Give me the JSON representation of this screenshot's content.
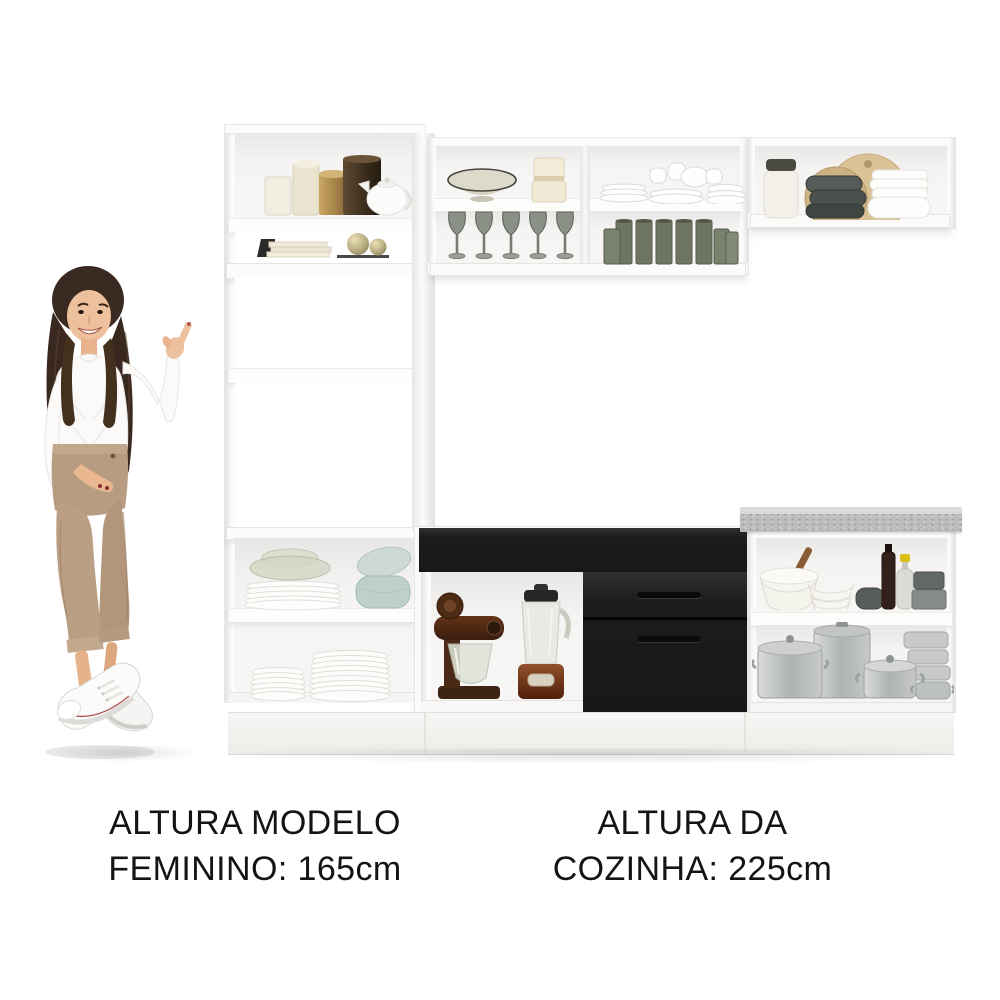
{
  "captions": {
    "model_height": {
      "line1": "ALTURA MODELO",
      "line2": "FEMININO: 165cm"
    },
    "kitchen_height": {
      "line1": "ALTURA DA",
      "line2": "COZINHA: 225cm"
    }
  },
  "measurements": {
    "model_height": "165cm",
    "kitchen_height": "225cm"
  },
  "colors": {
    "background": "#ffffff",
    "cabinet_white": "#f7f6f4",
    "cabinet_outline": "#e3e2e0",
    "drawer_black": "#1c1c1a",
    "countertop_gray": "#bcbebb",
    "text_black": "#141414",
    "hair_brown": "#3a2a21",
    "skin": "#eec19e",
    "pants_tan": "#b89c81",
    "sneaker_white": "#fbfbfa",
    "appliance_copper": "#7c3d20",
    "gold_tin": "#b3914f",
    "smoke_glass": "#6e7565",
    "blue_bowls": "#c3d4d0",
    "aluminum": "#b4b8b7",
    "cutting_board_wood": "#d8c296"
  },
  "scene": {
    "description": "White kitchen cabinet set with black drawers and gray countertop, female model pointing at it",
    "model": {
      "pose": "standing, pointing up toward the kitchen",
      "outfit": [
        "white long-sleeve knit top",
        "beige cropped trousers",
        "white sneakers"
      ]
    },
    "kitchen_items": [
      "mug, canisters and teapot",
      "books and ornament balls",
      "bowl and cream jars",
      "white cups and saucers",
      "smoked wine glasses",
      "green glass tumblers",
      "jar, cutting boards, gray and white bowls",
      "stand mixer",
      "blender",
      "plates with glass and blue bowls",
      "plate stacks",
      "mixing bowls, bottles and canisters",
      "aluminum pots and pans"
    ]
  }
}
